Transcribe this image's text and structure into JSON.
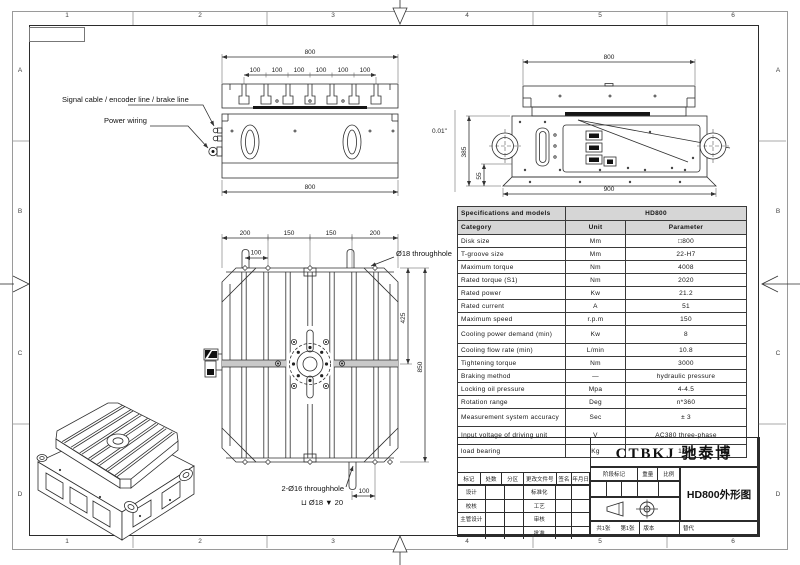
{
  "frame": {
    "top_numbers": [
      "1",
      "2",
      "3",
      "4",
      "5",
      "6"
    ],
    "bottom_numbers": [
      "1",
      "2",
      "3",
      "4",
      "5",
      "6"
    ],
    "left_letters": [
      "A",
      "B",
      "C",
      "D"
    ],
    "right_letters": [
      "A",
      "B",
      "C",
      "D"
    ]
  },
  "callouts": {
    "signal": "Signal cable / encoder line / brake line",
    "power": "Power wiring",
    "hole_top": "Ø18 throughhole",
    "hole_bottom": "2-Ø16 throughhole",
    "counterbore": "⊔ Ø18 ▼ 20",
    "flatness": "0.01\""
  },
  "dims": {
    "section_width": "800",
    "pitch": [
      "100",
      "100",
      "100",
      "100",
      "100",
      "100"
    ],
    "front_width": "800",
    "side_top_width": "800",
    "side_height": "385",
    "side_foot": "55",
    "side_base_width": "900",
    "plan_top": [
      "200",
      "150",
      "150",
      "200"
    ],
    "plan_100_top": "100",
    "plan_425": "425",
    "plan_850": "850",
    "plan_100_bottom": "100"
  },
  "spec_table": {
    "title": "Specifications and models",
    "model": "HD800",
    "columns": [
      "Category",
      "Unit",
      "Parameter"
    ],
    "rows": [
      [
        "Disk size",
        "Mm",
        "□800"
      ],
      [
        "T-groove size",
        "Mm",
        "22-H7"
      ],
      [
        "Maximum torque",
        "Nm",
        "4008"
      ],
      [
        "Rated torque (S1)",
        "Nm",
        "2020"
      ],
      [
        "Rated power",
        "Kw",
        "21.2"
      ],
      [
        "Rated current",
        "A",
        "51"
      ],
      [
        "Maximum speed",
        "r.p.m",
        "150"
      ],
      [
        "Cooling power demand (min)",
        "Kw",
        "8"
      ],
      [
        "Cooling flow rate (min)",
        "L/min",
        "10.8"
      ],
      [
        "Tightening torque",
        "Nm",
        "3000"
      ],
      [
        "Braking method",
        "—",
        "hydraulic pressure"
      ],
      [
        "Locking oil pressure",
        "Mpa",
        "4-4.5"
      ],
      [
        "Rotation range",
        "Deg",
        "n*360"
      ],
      [
        "Measurement system accuracy",
        "Sec",
        "± 3"
      ],
      [
        "Input voltage of driving unit",
        "V",
        "AC380 three-phase"
      ],
      [
        "load bearing",
        "Kg",
        "1800"
      ]
    ]
  },
  "title_block": {
    "company": "CTBKJ 驰泰博",
    "drawing_title": "HD800外形图",
    "stage_mark": "阶段标记",
    "weight": "重量",
    "scale": "比例",
    "rev_headers": [
      "标记",
      "处数",
      "分区",
      "更改文件号",
      "签名",
      "年月日"
    ],
    "sign_left": [
      "设计",
      "校核",
      "主管设计",
      ""
    ],
    "sign_mid": [
      "标准化",
      "工艺",
      "审核",
      "批准"
    ],
    "sheet_total": "共1张",
    "sheet_no": "第1张",
    "version": "版本",
    "replace": "替代"
  }
}
